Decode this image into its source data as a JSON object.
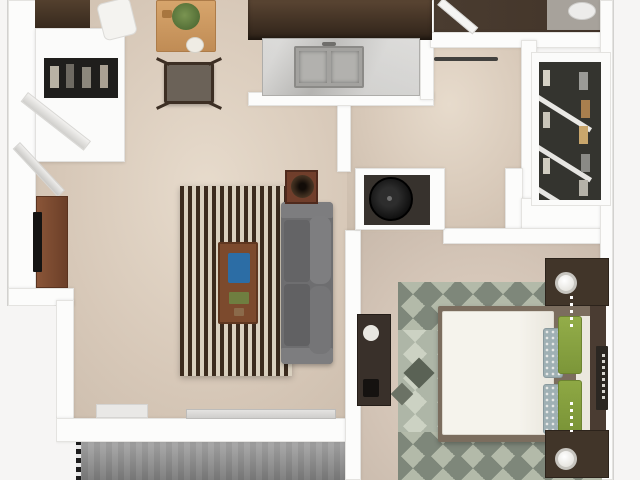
{
  "scene": {
    "title": "3D top-down floor plan of a one-bedroom apartment with balcony",
    "view": "top-down 3D render",
    "visible_text": "none"
  },
  "rooms": [
    {
      "id": "living-dining",
      "label": "Living / Dining Room",
      "floor_color": "#d7c8b8"
    },
    {
      "id": "kitchen",
      "label": "Kitchen",
      "floor_color": "#d7c8b8"
    },
    {
      "id": "hallway",
      "label": "Hallway",
      "floor_color": "#d7c8b8"
    },
    {
      "id": "bathroom",
      "label": "Bathroom",
      "floor_color": "#473a2e"
    },
    {
      "id": "walk-in-closet",
      "label": "Walk-in Closet",
      "floor_color": "#34342f"
    },
    {
      "id": "utility-closet",
      "label": "Utility / Laundry Closet",
      "floor_color": "#37322d"
    },
    {
      "id": "bedroom",
      "label": "Bedroom",
      "floor_color": "#d3c4b6"
    },
    {
      "id": "balcony",
      "label": "Balcony / Patio",
      "floor_color": "#8f8f8f"
    }
  ],
  "furniture": [
    {
      "id": "entry-wardrobe",
      "label": "Entry wardrobe with open doors",
      "color": "#fbfbfa"
    },
    {
      "id": "upper-cabinet",
      "label": "Dark cabinet top-left",
      "color": "#443325"
    },
    {
      "id": "dining-table",
      "label": "Wood dining table with plant",
      "color": "#cf9b61"
    },
    {
      "id": "dining-chair",
      "label": "Dining chair",
      "color": "#6b6258"
    },
    {
      "id": "white-chair",
      "label": "White dining chair",
      "color": "#f4f3f0"
    },
    {
      "id": "kitchen-cabinets",
      "label": "Dark kitchen cabinetry",
      "color": "#3f2f22"
    },
    {
      "id": "kitchen-sink",
      "label": "Double-basin sink in marble counter",
      "color": "#a3a29f"
    },
    {
      "id": "tv-stand",
      "label": "TV stand with flat TV",
      "color": "#7b4a31"
    },
    {
      "id": "striped-rug",
      "label": "Striped living-room rug",
      "color": "#3b2b1e"
    },
    {
      "id": "coffee-table",
      "label": "Coffee table with books",
      "color": "#7c4a2d"
    },
    {
      "id": "sofa",
      "label": "Gray sofa",
      "color": "#6e6e70"
    },
    {
      "id": "side-table-plant",
      "label": "Side table with potted plant",
      "color": "#703e2b"
    },
    {
      "id": "washer",
      "label": "Appliance in utility closet",
      "color": "#101010"
    },
    {
      "id": "closet-clothes",
      "label": "Hanging clothes in walk-in closet",
      "color": "#a97f4e"
    },
    {
      "id": "bed",
      "label": "Queen bed with white duvet and green pillows",
      "color": "#f4f2eb"
    },
    {
      "id": "nightstands",
      "label": "Two nightstands with crystal lamps",
      "color": "#413529"
    },
    {
      "id": "bedroom-desk",
      "label": "Dark desk against bedroom wall",
      "color": "#39302a"
    },
    {
      "id": "bedroom-rug",
      "label": "Diamond-pattern bedroom rug",
      "color": "#b4bcae"
    },
    {
      "id": "balcony-railing",
      "label": "Balcony railing",
      "color": "#1c1c1c"
    },
    {
      "id": "sliding-door",
      "label": "Sliding glass door to balcony",
      "color": "#d9d8d6"
    }
  ],
  "colors": {
    "walls": "#fcfcfb",
    "outside": "#f6f5f4",
    "floor_main": "#d7c8b8",
    "kitchen_dark": "#3f2f22",
    "marble": "#c6c5c2",
    "rug_stripe_dark": "#3b2b1e",
    "rug_stripe_light": "#d9d0bf",
    "bedroom_rug_light": "#ccd2c3",
    "bedroom_rug_dark": "#7e877a",
    "pillow_green": "#8aa342",
    "balcony_gray": "#8f8f8f"
  }
}
